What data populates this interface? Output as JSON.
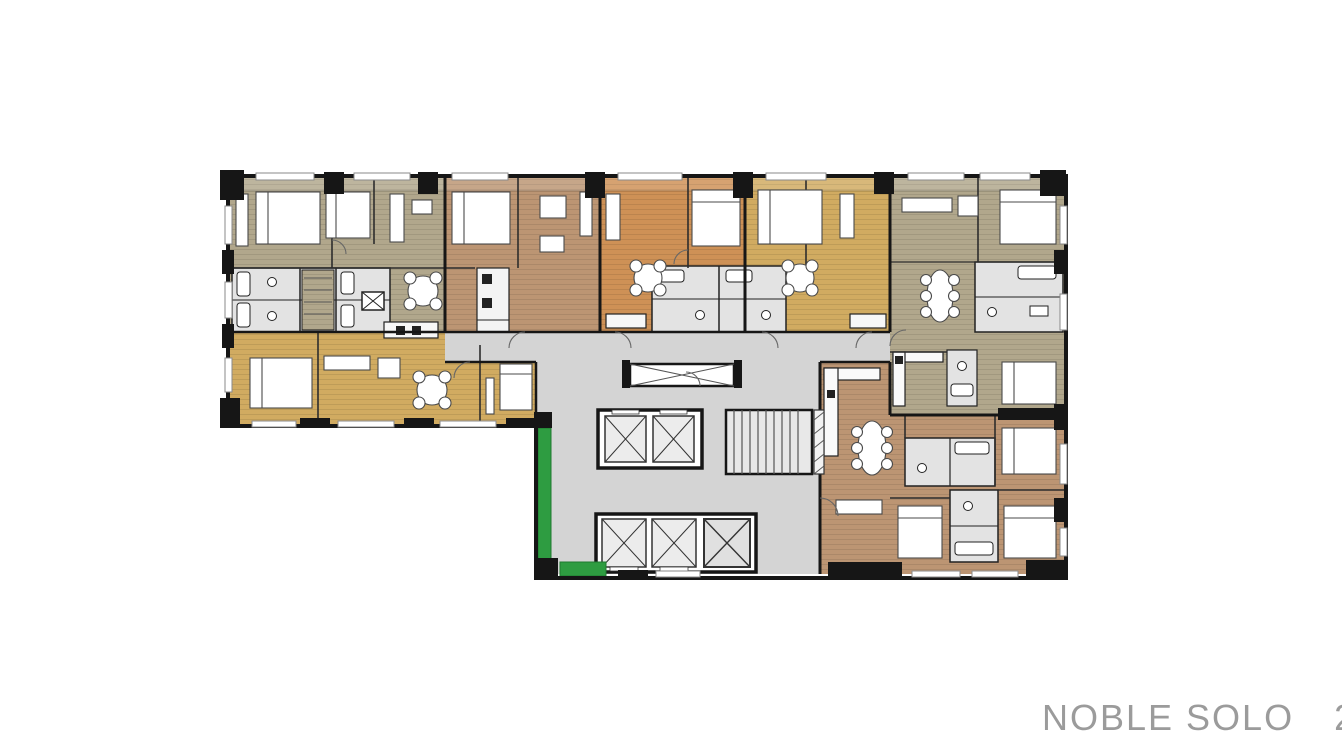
{
  "caption": {
    "project": "NOBLE SOLO",
    "floor": "23"
  },
  "palette": {
    "background": "#ffffff",
    "wall": "#161616",
    "olive": "#b1a78c",
    "brown": "#bc9573",
    "orange": "#ce9156",
    "gold": "#d1ab61",
    "corridor": "#d4d4d4",
    "bathroom": "#e3e3e3",
    "fixture": "#ffffff",
    "green": "#2e9c41",
    "caption_text": "#9b9b9b"
  },
  "units": [
    {
      "id": "A",
      "position": "top-left",
      "color": "olive"
    },
    {
      "id": "B",
      "position": "top-second",
      "color": "brown"
    },
    {
      "id": "C",
      "position": "top-center",
      "color": "orange"
    },
    {
      "id": "D",
      "position": "top-fourth",
      "color": "gold"
    },
    {
      "id": "E",
      "position": "right-wing",
      "color": "olive"
    },
    {
      "id": "F",
      "position": "bottom-right",
      "color": "brown"
    },
    {
      "id": "G",
      "position": "bottom-left",
      "color": "gold"
    }
  ],
  "core": {
    "elevators_upper": 2,
    "elevators_lower": 3,
    "stairwell": true,
    "garden_strips": 2
  }
}
